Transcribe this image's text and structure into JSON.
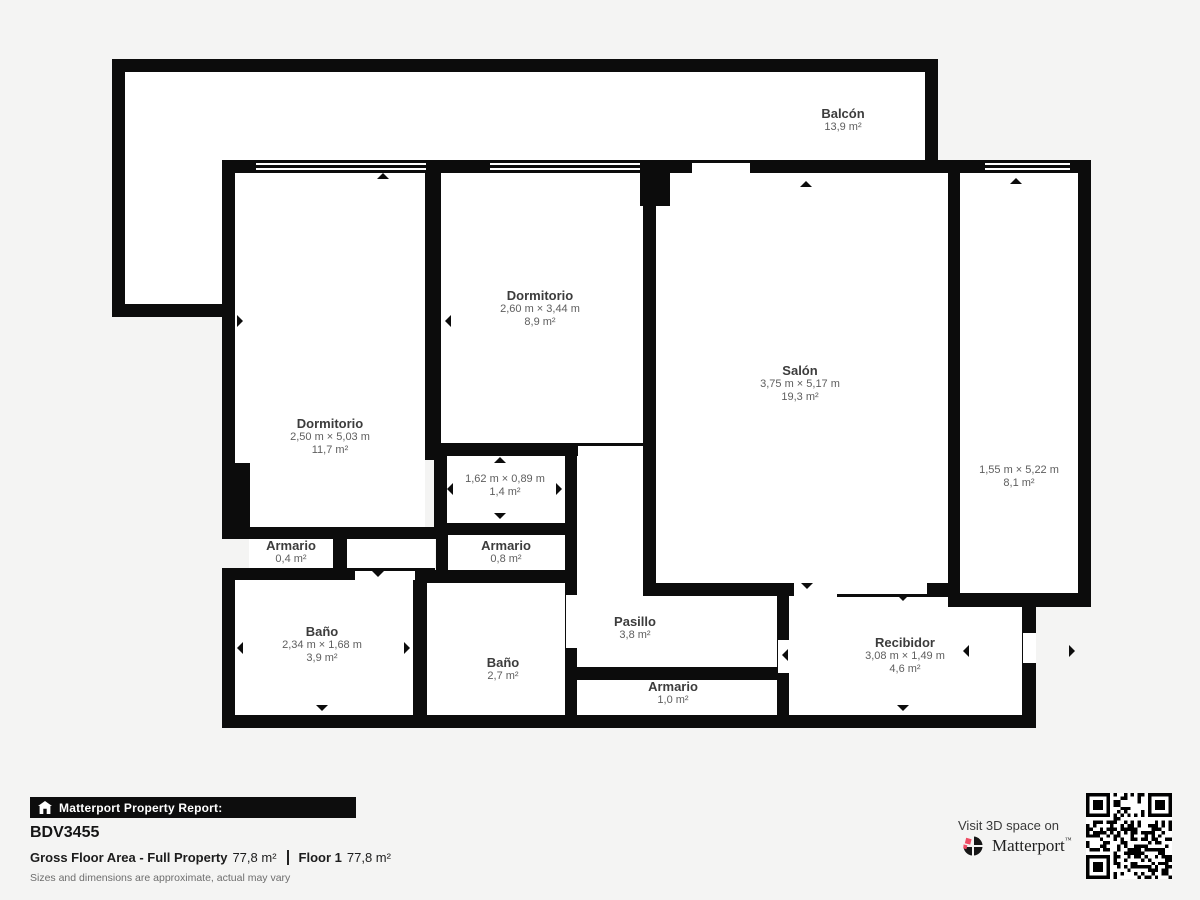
{
  "colors": {
    "wall": "#0c0c0c",
    "background": "#f4f4f3",
    "brand_red": "#ee4b63"
  },
  "rooms": {
    "balcon": {
      "name": "Balcón",
      "dims": "",
      "area": "13,9 m²"
    },
    "dormitorio_mid": {
      "name": "Dormitorio",
      "dims": "2,60 m × 3,44 m",
      "area": "8,9 m²"
    },
    "salon": {
      "name": "Salón",
      "dims": "3,75 m × 5,17 m",
      "area": "19,3 m²"
    },
    "dormitorio_left": {
      "name": "Dormitorio",
      "dims": "2,50 m × 5,03 m",
      "area": "11,7 m²"
    },
    "room_right": {
      "name": "",
      "dims": "1,55 m × 5,22 m",
      "area": "8,1 m²"
    },
    "closet": {
      "name": "",
      "dims": "1,62 m × 0,89 m",
      "area": "1,4 m²"
    },
    "armario_left": {
      "name": "Armario",
      "dims": "",
      "area": "0,4 m²"
    },
    "armario_mid": {
      "name": "Armario",
      "dims": "",
      "area": "0,8 m²"
    },
    "bano_left": {
      "name": "Baño",
      "dims": "2,34 m × 1,68 m",
      "area": "3,9 m²"
    },
    "bano_mid": {
      "name": "Baño",
      "dims": "",
      "area": "2,7 m²"
    },
    "pasillo": {
      "name": "Pasillo",
      "dims": "",
      "area": "3,8 m²"
    },
    "armario_bottom": {
      "name": "Armario",
      "dims": "",
      "area": "1,0 m²"
    },
    "recibidor": {
      "name": "Recibidor",
      "dims": "3,08 m × 1,49 m",
      "area": "4,6 m²"
    }
  },
  "footer": {
    "report_label": "Matterport Property Report:",
    "property_id": "BDV3455",
    "gross_label": "Gross Floor Area - Full Property",
    "gross_value": "77,8 m²",
    "floor_label": "Floor 1",
    "floor_value": "77,8 m²",
    "disclaimer": "Sizes and dimensions are approximate, actual may vary",
    "visit_label": "Visit 3D space on",
    "brand": "Matterport",
    "brand_mark": "™"
  }
}
